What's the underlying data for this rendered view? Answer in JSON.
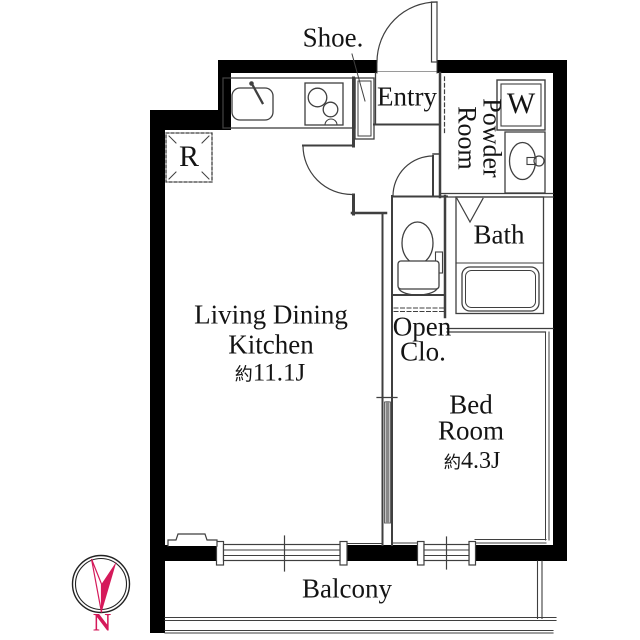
{
  "plan": {
    "rooms": {
      "ldk": {
        "line1": "Living Dining",
        "line2": "Kitchen",
        "size_prefix": "約",
        "size_value": "11.1J"
      },
      "bedroom": {
        "line1": "Bed",
        "line2": "Room",
        "size_prefix": "約",
        "size_value": "4.3J"
      },
      "entry": {
        "label": "Entry"
      },
      "bath": {
        "label": "Bath"
      },
      "powder_room": {
        "label": "Powder\nRoom"
      },
      "open_closet": {
        "line1": "Open",
        "line2": "Clo."
      },
      "shoe_closet": {
        "label": "Shoe."
      },
      "balcony": {
        "label": "Balcony"
      }
    },
    "fixtures": {
      "washing_machine": "W",
      "refrigerator": "R"
    },
    "compass": {
      "north_label": "N"
    },
    "colors": {
      "wall": "#000000",
      "line": "#3f3f3f",
      "accent": "#d5195a",
      "text": "#141414"
    }
  }
}
